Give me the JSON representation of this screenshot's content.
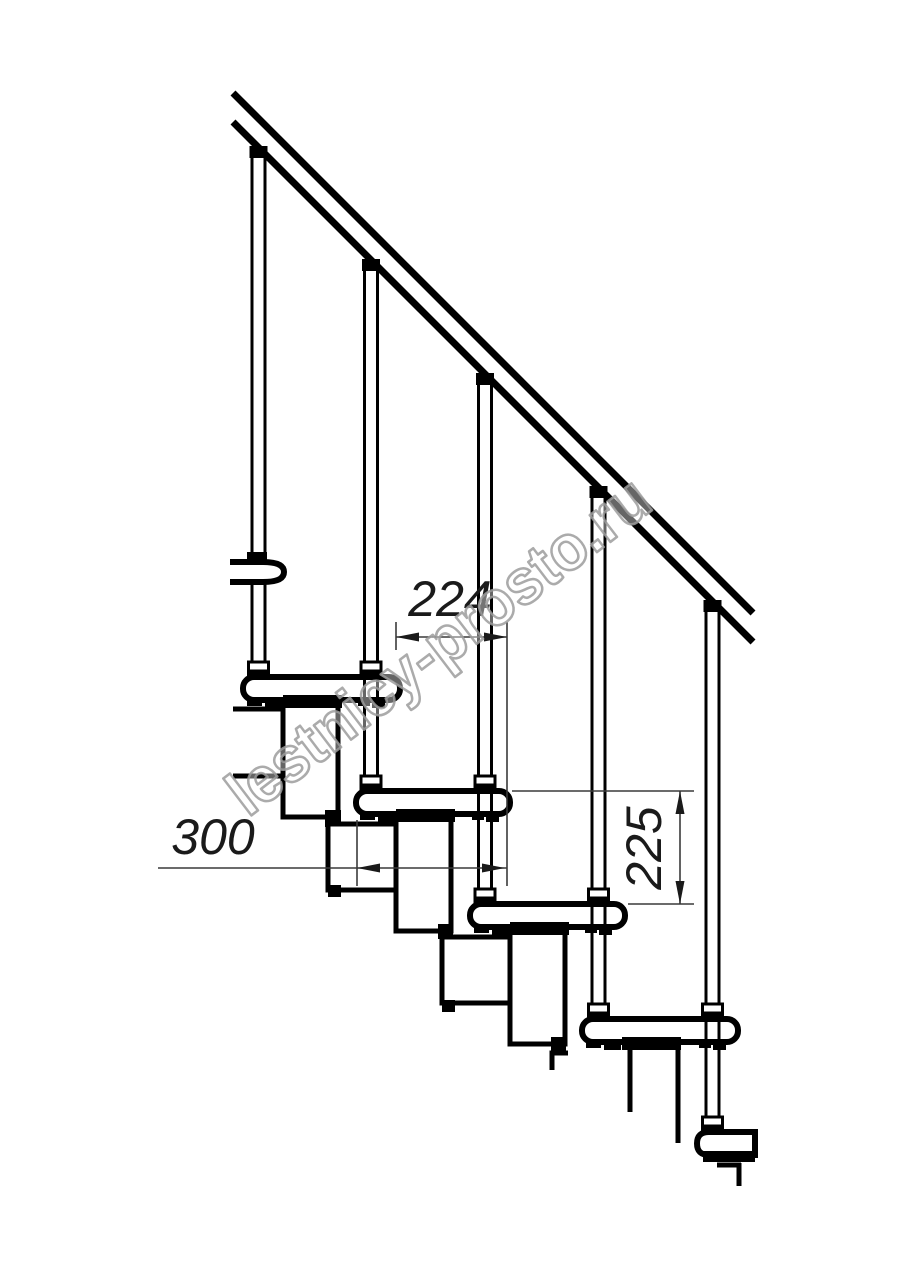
{
  "drawing": {
    "type": "modular-staircase-side-view-fragment",
    "watermark": "lestnicy-prosto.ru",
    "dimensions": {
      "step_run": "224",
      "tread_depth": "300",
      "step_rise": "225"
    },
    "colors": {
      "line": "#000000",
      "dimension_line": "#3a3a3a",
      "watermark_stroke": "#9c9c9c",
      "background": "#ffffff"
    }
  }
}
